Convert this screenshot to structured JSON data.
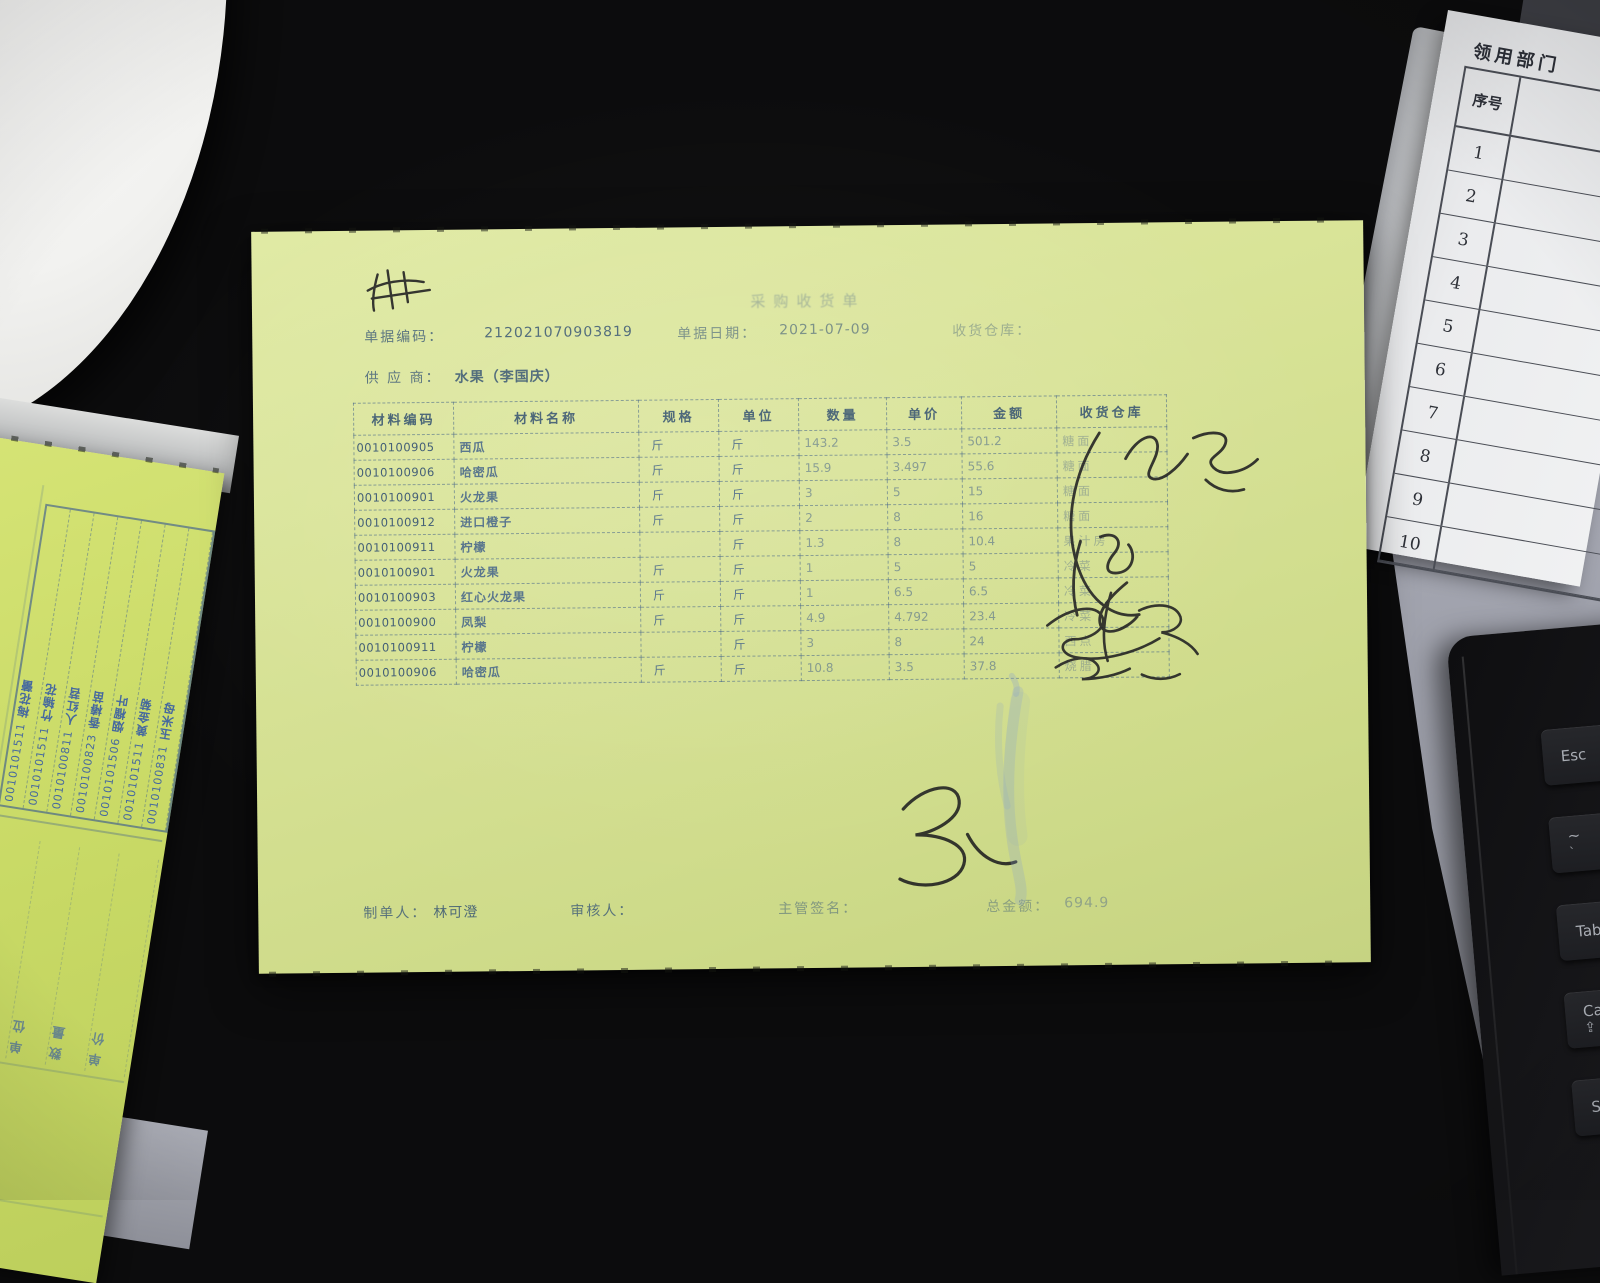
{
  "receipt": {
    "title": "采购收货单",
    "fields": {
      "doc_code_label": "单据编码：",
      "doc_code": "212021070903819",
      "doc_date_label": "单据日期：",
      "doc_date": "2021-07-09",
      "recv_warehouse_label": "收货仓库：",
      "recv_warehouse": "",
      "supplier_label": "供 应 商：",
      "supplier": "水果（李国庆）"
    },
    "table": {
      "headers": [
        "材料编码",
        "材料名称",
        "规格",
        "单位",
        "数量",
        "单价",
        "金额",
        "收货仓库"
      ],
      "rows": [
        [
          "0010100905",
          "西瓜",
          "斤",
          "斤",
          "143.2",
          "3.5",
          "501.2",
          "糖面"
        ],
        [
          "0010100906",
          "哈密瓜",
          "斤",
          "斤",
          "15.9",
          "3.497",
          "55.6",
          "糖面"
        ],
        [
          "0010100901",
          "火龙果",
          "斤",
          "斤",
          "3",
          "5",
          "15",
          "糖面"
        ],
        [
          "0010100912",
          "进口橙子",
          "斤",
          "斤",
          "2",
          "8",
          "16",
          "糖面"
        ],
        [
          "0010100911",
          "柠檬",
          "",
          "斤",
          "1.3",
          "8",
          "10.4",
          "果汁房"
        ],
        [
          "0010100901",
          "火龙果",
          "斤",
          "斤",
          "1",
          "5",
          "5",
          "冷菜"
        ],
        [
          "0010100903",
          "红心火龙果",
          "斤",
          "斤",
          "1",
          "6.5",
          "6.5",
          "冷菜"
        ],
        [
          "0010100900",
          "凤梨",
          "斤",
          "斤",
          "4.9",
          "4.792",
          "23.4",
          "冷菜"
        ],
        [
          "0010100911",
          "柠檬",
          "",
          "斤",
          "3",
          "8",
          "24",
          "西点"
        ],
        [
          "0010100906",
          "哈密瓜",
          "斤",
          "斤",
          "10.8",
          "3.5",
          "37.8",
          "烧腊"
        ]
      ]
    },
    "footer": {
      "maker_label": "制单人：",
      "maker": "林可澄",
      "auditor_label": "审核人：",
      "auditor": "",
      "manager_label": "主管签名：",
      "manager": "",
      "total_label": "总金额：",
      "total": "694.9"
    }
  },
  "left_paper": {
    "entries": [
      {
        "code": "0010101511",
        "name": "梅花蕾"
      },
      {
        "code": "0010101511",
        "name": "竹输花"
      },
      {
        "code": "0010100811",
        "name": "人红苕"
      },
      {
        "code": "0010100823",
        "name": "香椿苗"
      },
      {
        "code": "0010101506",
        "name": "烟榴叶"
      },
      {
        "code": "0010101511",
        "name": "黄金菊"
      },
      {
        "code": "0010100831",
        "name": "玉米母"
      }
    ],
    "column_headers": [
      "规格",
      "单位",
      "数量",
      "单价"
    ],
    "unit_char": "斤"
  },
  "right_paper": {
    "title": "领用部门",
    "serial_header": "序号",
    "serials": [
      "1",
      "2",
      "3",
      "4",
      "5",
      "6",
      "7",
      "8",
      "9",
      "10"
    ]
  },
  "keyboard": {
    "keys": [
      {
        "label": "Esc",
        "sub": "",
        "icon": ""
      },
      {
        "label": "~",
        "sub": "`",
        "icon": ""
      },
      {
        "label": "Tab",
        "sub": "",
        "icon": ""
      },
      {
        "label": "Caps",
        "sub": "",
        "icon": "⇪"
      },
      {
        "label": "Shift",
        "sub": "",
        "icon": ""
      }
    ]
  },
  "colors": {
    "paper_green": "#d6e293",
    "print_blue": "#46688a",
    "stamp_blue": "#2f55a8",
    "desk_gray": "#a6a8b3",
    "laptop_black": "#0d0d0e",
    "ink_black": "#1c1c1e"
  }
}
